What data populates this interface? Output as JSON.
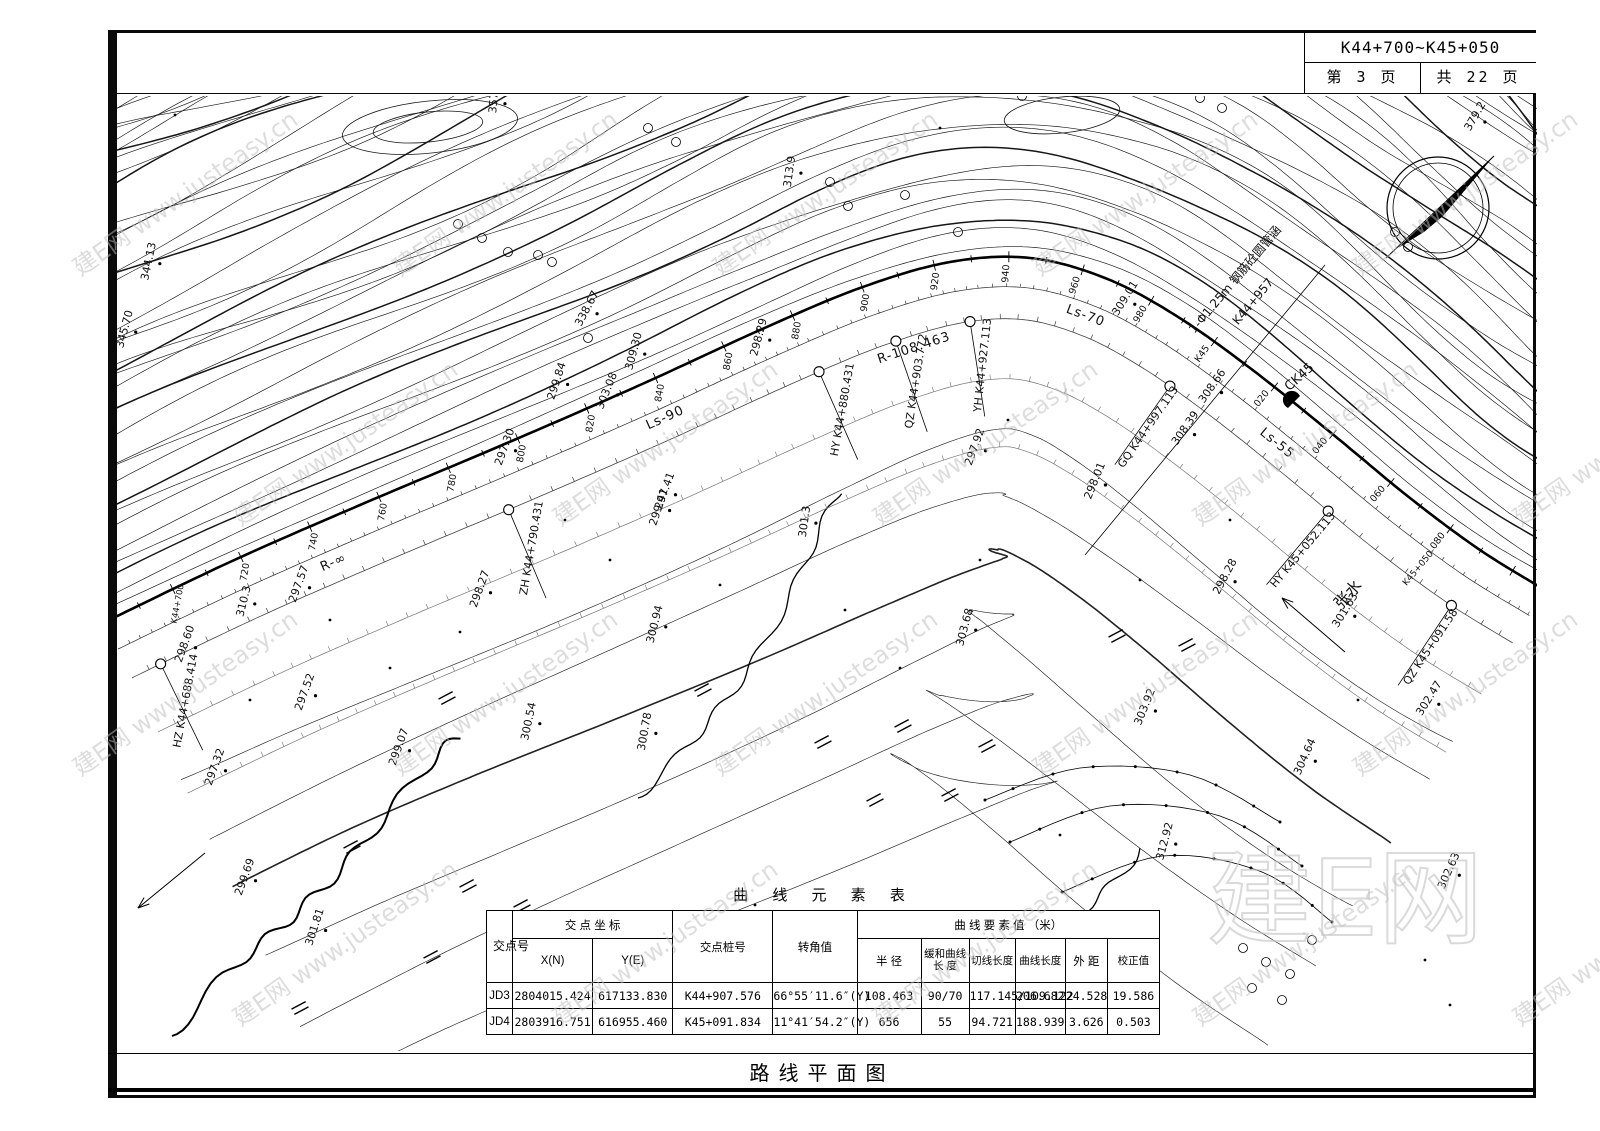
{
  "sheet": {
    "station_range": "K44+700~K45+050",
    "page_label": "第 3 页",
    "total_label": "共 22 页",
    "footer_title": "路线平面图"
  },
  "watermark": {
    "brand": "建E网",
    "url": "www.justeasy.cn"
  },
  "table": {
    "title": "曲 线 元 素 表",
    "headers": {
      "jiaodian": "交点号",
      "coords": "交 点 坐 标",
      "xn": "X(N)",
      "ye": "Y(E)",
      "stake": "交点桩号",
      "angle": "转角值",
      "elements": "曲 线 要 素 值 （米）",
      "radius": "半 径",
      "spiral": "缓和曲线 长 度",
      "tangent": "切线长度",
      "curvelen": "曲线长度",
      "external": "外 距",
      "correction": "校正值"
    },
    "rows": [
      {
        "id": "JD3",
        "x": "2804015.424",
        "y": "617133.830",
        "stake": "K44+907.576",
        "angle": "66°55′11.6″(Y)",
        "radius": "108.463",
        "spiral": "90/70",
        "tangent": "117.145/109.122",
        "length": "206.682",
        "external": "24.528",
        "correction": "19.586"
      },
      {
        "id": "JD4",
        "x": "2803916.751",
        "y": "616955.460",
        "stake": "K45+091.834",
        "angle": "11°41′54.2″(Y)",
        "radius": "656",
        "spiral": "55",
        "tangent": "94.721",
        "length": "188.939",
        "external": "3.626",
        "correction": "0.503"
      }
    ]
  },
  "map": {
    "stations": [
      {
        "t": "K44+700",
        "s": 700
      },
      {
        "t": "720",
        "s": 720
      },
      {
        "t": "740",
        "s": 740
      },
      {
        "t": "760",
        "s": 760
      },
      {
        "t": "780",
        "s": 780
      },
      {
        "t": "800",
        "s": 800
      },
      {
        "t": "820",
        "s": 820
      },
      {
        "t": "840",
        "s": 840
      },
      {
        "t": "860",
        "s": 860
      },
      {
        "t": "880",
        "s": 880
      },
      {
        "t": "900",
        "s": 900
      },
      {
        "t": "920",
        "s": 920
      },
      {
        "t": "940",
        "s": 940
      },
      {
        "t": "960",
        "s": 960
      },
      {
        "t": "980",
        "s": 980
      },
      {
        "t": "K45",
        "s": 1000
      },
      {
        "t": "020",
        "s": 1020
      },
      {
        "t": "040",
        "s": 1040
      },
      {
        "t": "060",
        "s": 1060
      },
      {
        "t": "080",
        "s": 1080
      }
    ],
    "curve_points": [
      {
        "label": "HZ K44+688.414",
        "station": 688.414
      },
      {
        "label": "ZH K44+790.431",
        "station": 790.431
      },
      {
        "label": "HY K44+880.431",
        "station": 880.431
      },
      {
        "label": "QZ K44+903.772",
        "station": 903.772
      },
      {
        "label": "YH K44+927.113",
        "station": 927.113
      },
      {
        "label": "GQ K44+997.113",
        "station": 997.113
      },
      {
        "label": "HY K45+052.113",
        "station": 1052.113
      },
      {
        "label": "QZ K45+091.58",
        "station": 1091.58
      }
    ],
    "alignment_labels": [
      {
        "t": "R-∞",
        "s": 742,
        "off": 46
      },
      {
        "t": "Ls-90",
        "s": 838,
        "off": 44
      },
      {
        "t": "R-108.463",
        "s": 908,
        "off": 78
      },
      {
        "t": "Ls-70",
        "s": 965,
        "off": 46
      },
      {
        "t": "Ls-55",
        "s": 1030,
        "off": 46
      }
    ],
    "elevations": [
      {
        "t": "344.13",
        "x": 152,
        "y": 262,
        "r": -78
      },
      {
        "t": "357",
        "x": 497,
        "y": 103,
        "r": -85
      },
      {
        "t": "345.70",
        "x": 128,
        "y": 330,
        "r": -75
      },
      {
        "t": "338.67",
        "x": 590,
        "y": 310,
        "r": -62
      },
      {
        "t": "313.9",
        "x": 793,
        "y": 172,
        "r": -82
      },
      {
        "t": "309.30",
        "x": 637,
        "y": 352,
        "r": -75
      },
      {
        "t": "303.08",
        "x": 610,
        "y": 392,
        "r": -68
      },
      {
        "t": "297.30",
        "x": 508,
        "y": 448,
        "r": -70
      },
      {
        "t": "298.29",
        "x": 762,
        "y": 338,
        "r": -75
      },
      {
        "t": "299.84",
        "x": 560,
        "y": 382,
        "r": -72
      },
      {
        "t": "310.3",
        "x": 247,
        "y": 602,
        "r": -76
      },
      {
        "t": "297.41",
        "x": 668,
        "y": 492,
        "r": -70
      },
      {
        "t": "297.57",
        "x": 302,
        "y": 585,
        "r": -70
      },
      {
        "t": "297.52",
        "x": 308,
        "y": 693,
        "r": -70
      },
      {
        "t": "297.32",
        "x": 218,
        "y": 768,
        "r": -70
      },
      {
        "t": "298.60",
        "x": 188,
        "y": 645,
        "r": -70
      },
      {
        "t": "298.27",
        "x": 483,
        "y": 590,
        "r": -70
      },
      {
        "t": "299.07",
        "x": 402,
        "y": 748,
        "r": -70
      },
      {
        "t": "299.41",
        "x": 662,
        "y": 508,
        "r": -72
      },
      {
        "t": "300.94",
        "x": 658,
        "y": 625,
        "r": -76
      },
      {
        "t": "300.54",
        "x": 532,
        "y": 722,
        "r": -78
      },
      {
        "t": "300.78",
        "x": 648,
        "y": 732,
        "r": -80
      },
      {
        "t": "301.3",
        "x": 808,
        "y": 522,
        "r": -82
      },
      {
        "t": "301.81",
        "x": 318,
        "y": 928,
        "r": -72
      },
      {
        "t": "299.69",
        "x": 248,
        "y": 878,
        "r": -70
      },
      {
        "t": "303.68",
        "x": 968,
        "y": 628,
        "r": -75
      },
      {
        "t": "297.92",
        "x": 978,
        "y": 448,
        "r": -70
      },
      {
        "t": "298.01",
        "x": 1098,
        "y": 482,
        "r": -68
      },
      {
        "t": "301.63",
        "x": 1348,
        "y": 612,
        "r": -58
      },
      {
        "t": "298.28",
        "x": 1228,
        "y": 578,
        "r": -62
      },
      {
        "t": "303.92",
        "x": 1148,
        "y": 708,
        "r": -68
      },
      {
        "t": "304.64",
        "x": 1308,
        "y": 758,
        "r": -66
      },
      {
        "t": "312.92",
        "x": 1168,
        "y": 842,
        "r": -75
      },
      {
        "t": "302.63",
        "x": 1452,
        "y": 872,
        "r": -66
      },
      {
        "t": "308.66",
        "x": 1215,
        "y": 388,
        "r": -55
      },
      {
        "t": "308.39",
        "x": 1188,
        "y": 430,
        "r": -55
      },
      {
        "t": "309.01",
        "x": 1128,
        "y": 300,
        "r": -58
      },
      {
        "t": "302.47",
        "x": 1432,
        "y": 700,
        "r": -58
      },
      {
        "t": "379.2",
        "x": 1478,
        "y": 118,
        "r": -60
      }
    ],
    "features": [
      {
        "t": "1-Φ1.25m 钢筋砼圆管涵",
        "x": 1238,
        "y": 282,
        "r": -50,
        "fs": 12
      },
      {
        "t": "K44+957",
        "x": 1256,
        "y": 304,
        "r": -50,
        "fs": 12
      },
      {
        "t": "CK45",
        "x": 1302,
        "y": 380,
        "r": -42,
        "fs": 13
      },
      {
        "t": "张水",
        "x": 1352,
        "y": 598,
        "r": -48,
        "fs": 16
      },
      {
        "t": "K45+050",
        "x": 1420,
        "y": 570,
        "r": -50,
        "fs": 9
      }
    ]
  }
}
